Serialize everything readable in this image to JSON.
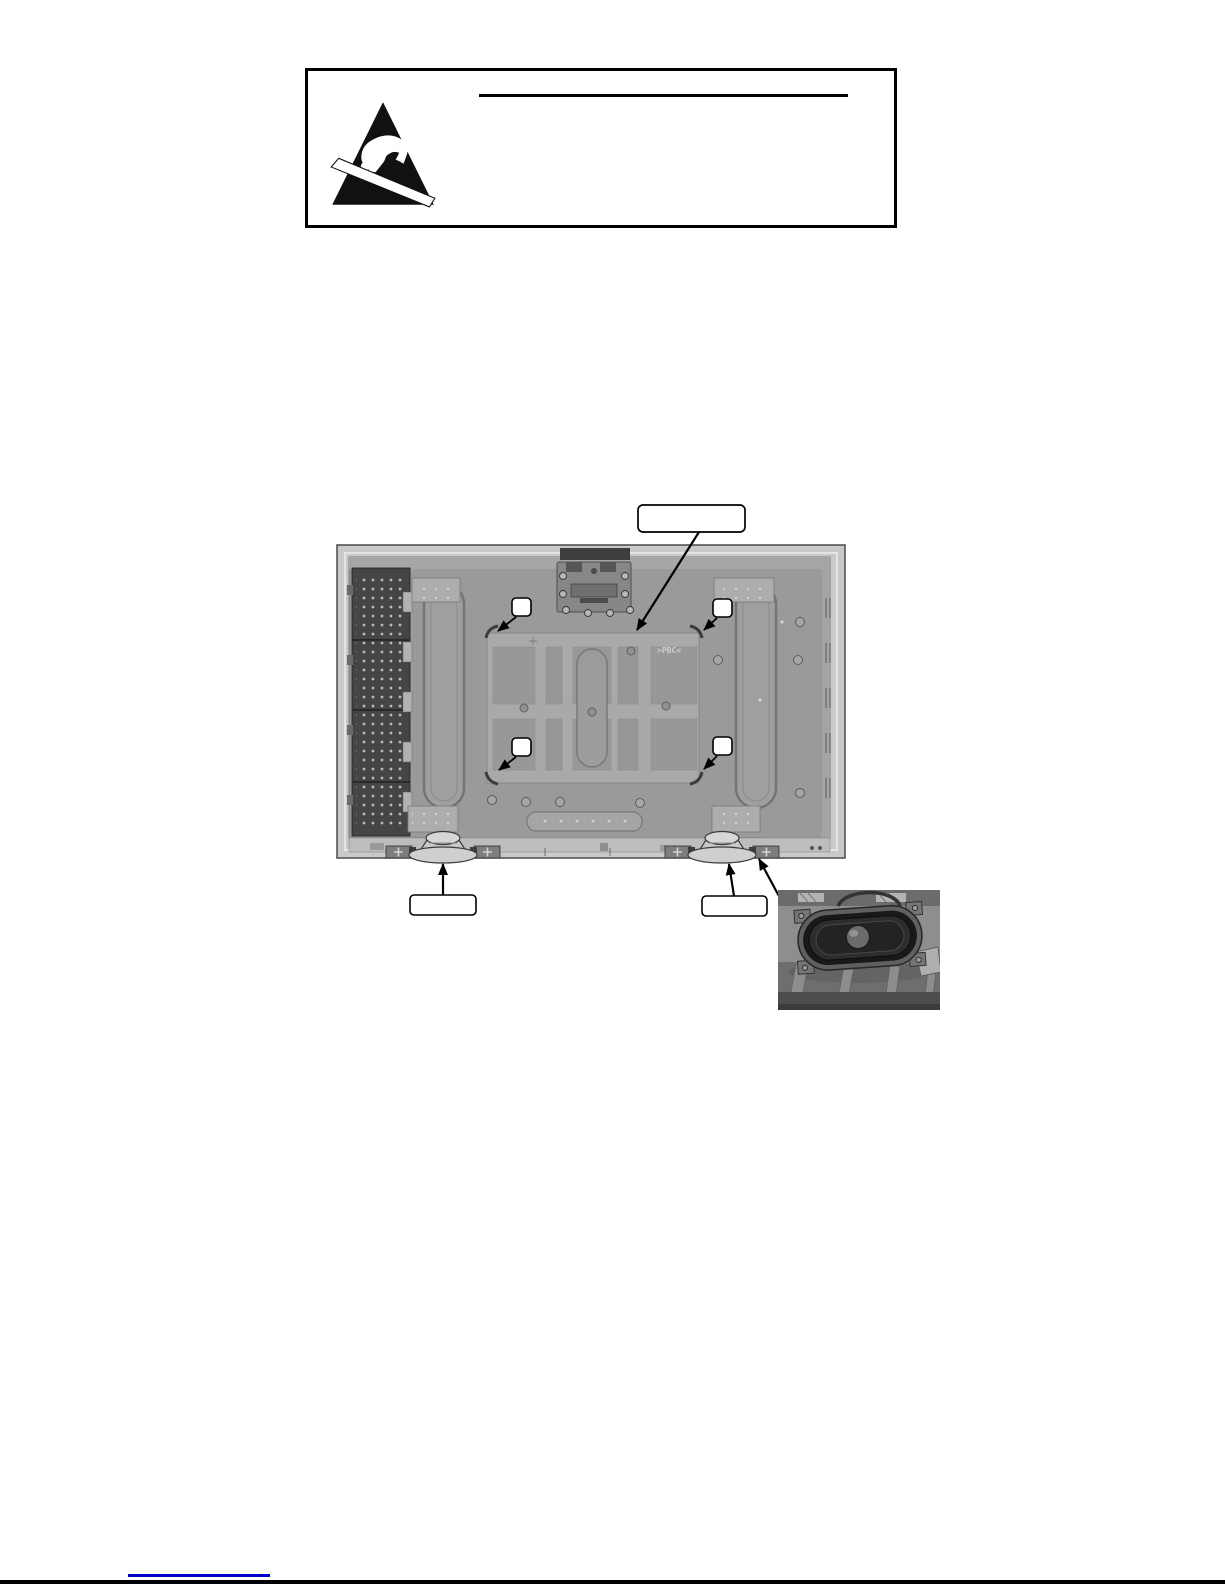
{
  "page": {
    "background": "#ffffff",
    "bottom_rule_color": "#000000",
    "footer_link": {
      "text": "",
      "underline_color": "#0000cc"
    }
  },
  "warning_box": {
    "border_color": "#000000",
    "heading_text": "",
    "heading_underline_color": "#000000"
  },
  "icons": {
    "esd": "esd-warning-triangle-icon",
    "speaker_inset": "speaker-closeup-photo"
  },
  "rear_panel_diagram": {
    "marking_text": ">PBC<",
    "marking_color": "#cfcfcf",
    "callout_boxes": {
      "top_label": "",
      "screw_top_left_label": "",
      "screw_top_right_label": "",
      "screw_bottom_left_label": "",
      "screw_bottom_right_label": "",
      "left_speaker_label": "",
      "right_speaker_label": ""
    },
    "counts": {
      "screw_callouts": 4,
      "speakers": 2
    },
    "colors": {
      "frame": "#c9c9c9",
      "chassis": "#9a9a9a",
      "mount_plate": "#a9a9a9",
      "recess": "#989898",
      "board": "#454545",
      "callout_fill": "#ffffff",
      "line": "#000000"
    }
  }
}
